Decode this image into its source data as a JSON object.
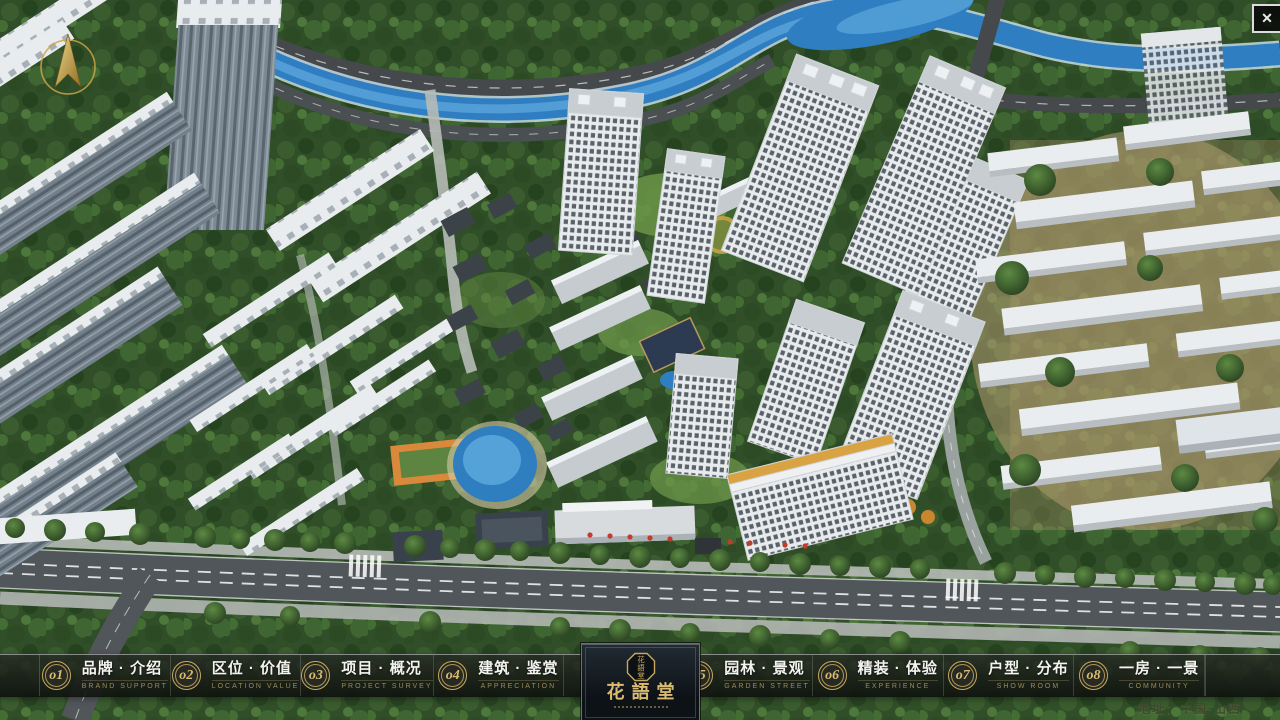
{
  "window": {
    "close_glyph": "✕"
  },
  "brand": {
    "logo_title": "花語堂",
    "seal_chars": [
      "花",
      "語",
      "堂"
    ]
  },
  "nav": {
    "items": [
      {
        "num": "o1",
        "zh": "品牌 · 介绍",
        "en": "BRAND SUPPORT"
      },
      {
        "num": "o2",
        "zh": "区位 · 价值",
        "en": "LOCATION VALUE"
      },
      {
        "num": "o3",
        "zh": "项目 · 概况",
        "en": "PROJECT SURVEY"
      },
      {
        "num": "o4",
        "zh": "建筑 · 鉴赏",
        "en": "APPRECIATION"
      },
      {
        "num": "o5",
        "zh": "园林 · 景观",
        "en": "GARDEN STREET"
      },
      {
        "num": "o6",
        "zh": "精装 · 体验",
        "en": "EXPERIENCE"
      },
      {
        "num": "o7",
        "zh": "户型 · 分布",
        "en": "SHOW ROOM"
      },
      {
        "num": "o8",
        "zh": "一房 · 一景",
        "en": "COMMUNITY"
      }
    ]
  },
  "footer": {
    "address": "地址：中国·山西"
  },
  "colors": {
    "gold_accent": "#c9a95f",
    "nav_text": "#f3f3ef",
    "nav_subtext": "#9d8b57",
    "river_blue": "#2f7ec2",
    "tree_green": "#2f4d27",
    "road_asphalt": "#51565a",
    "building_white": "#e9edf0"
  }
}
